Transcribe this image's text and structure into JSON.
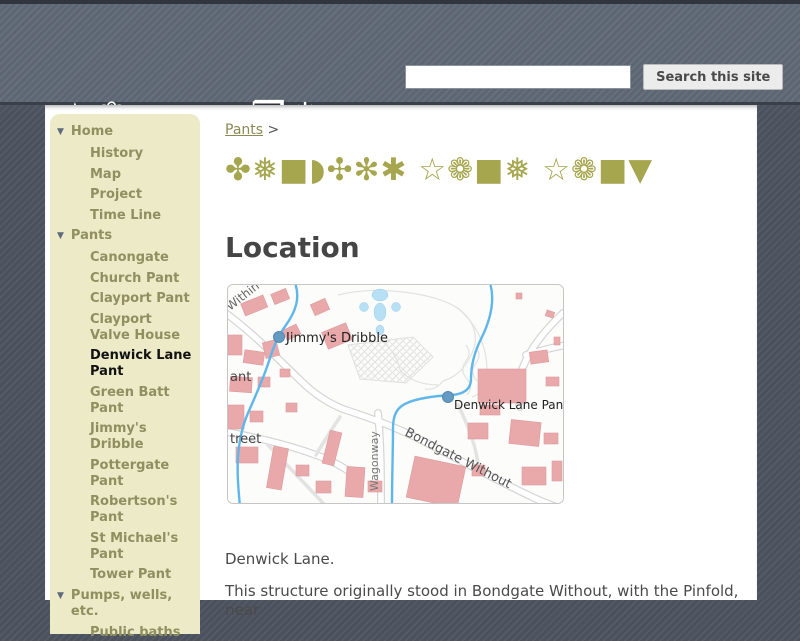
{
  "header": {
    "logo": {
      "line1": "☆❁■▼▲ ❒❅",
      "line2": "✡●■◗✣✻✱"
    },
    "search": {
      "value": "",
      "placeholder": "",
      "button_label": "Search this site"
    }
  },
  "sidebar": {
    "sections": [
      {
        "label": "Home",
        "items": [
          "History",
          "Map",
          "Project",
          "Time Line"
        ]
      },
      {
        "label": "Pants",
        "items": [
          "Canongate",
          "Church Pant",
          "Clayport Pant",
          "Clayport Valve House",
          "Denwick Lane Pant",
          "Green Batt Pant",
          "Jimmy's Dribble",
          "Pottergate Pant",
          "Robertson's Pant",
          "St Michael's Pant",
          "Tower Pant"
        ],
        "active_item": "Denwick Lane Pant"
      },
      {
        "label": "Pumps, wells, etc.",
        "items": [
          "Public baths"
        ]
      }
    ]
  },
  "main": {
    "breadcrumb": {
      "link_label": "Pants",
      "separator": ">"
    },
    "page_title_symbols": "✤❅■◗✣✻✱ ☆❁■❅ ☆❁■▼",
    "section_heading": "Location",
    "map": {
      "marker1_label": "Jimmy's Dribble",
      "marker2_label": "Denwick Lane Pant",
      "street_within": "Within",
      "street_pant_partial": "ant",
      "street_partial": "treet",
      "street_bondgate": "Bondgate Without",
      "street_wagonway": "Wagonway"
    },
    "paragraph1": "Denwick Lane.",
    "paragraph2": "This structure originally stood in Bondgate Without, with the Pinfold, near"
  },
  "colors": {
    "header_bg": "#5d6673",
    "page_margin_bg": "#4b525e",
    "sidebar_bg": "#edeac7",
    "sidebar_text": "#8f8f60",
    "active_item_text": "#111111",
    "accent_olive": "#a6a64f",
    "link_olive": "#8a8a55",
    "heading_gray": "#454545",
    "map_building": "#e9a9ab",
    "map_water": "#5fb6ea",
    "map_marker": "#649bc4"
  }
}
